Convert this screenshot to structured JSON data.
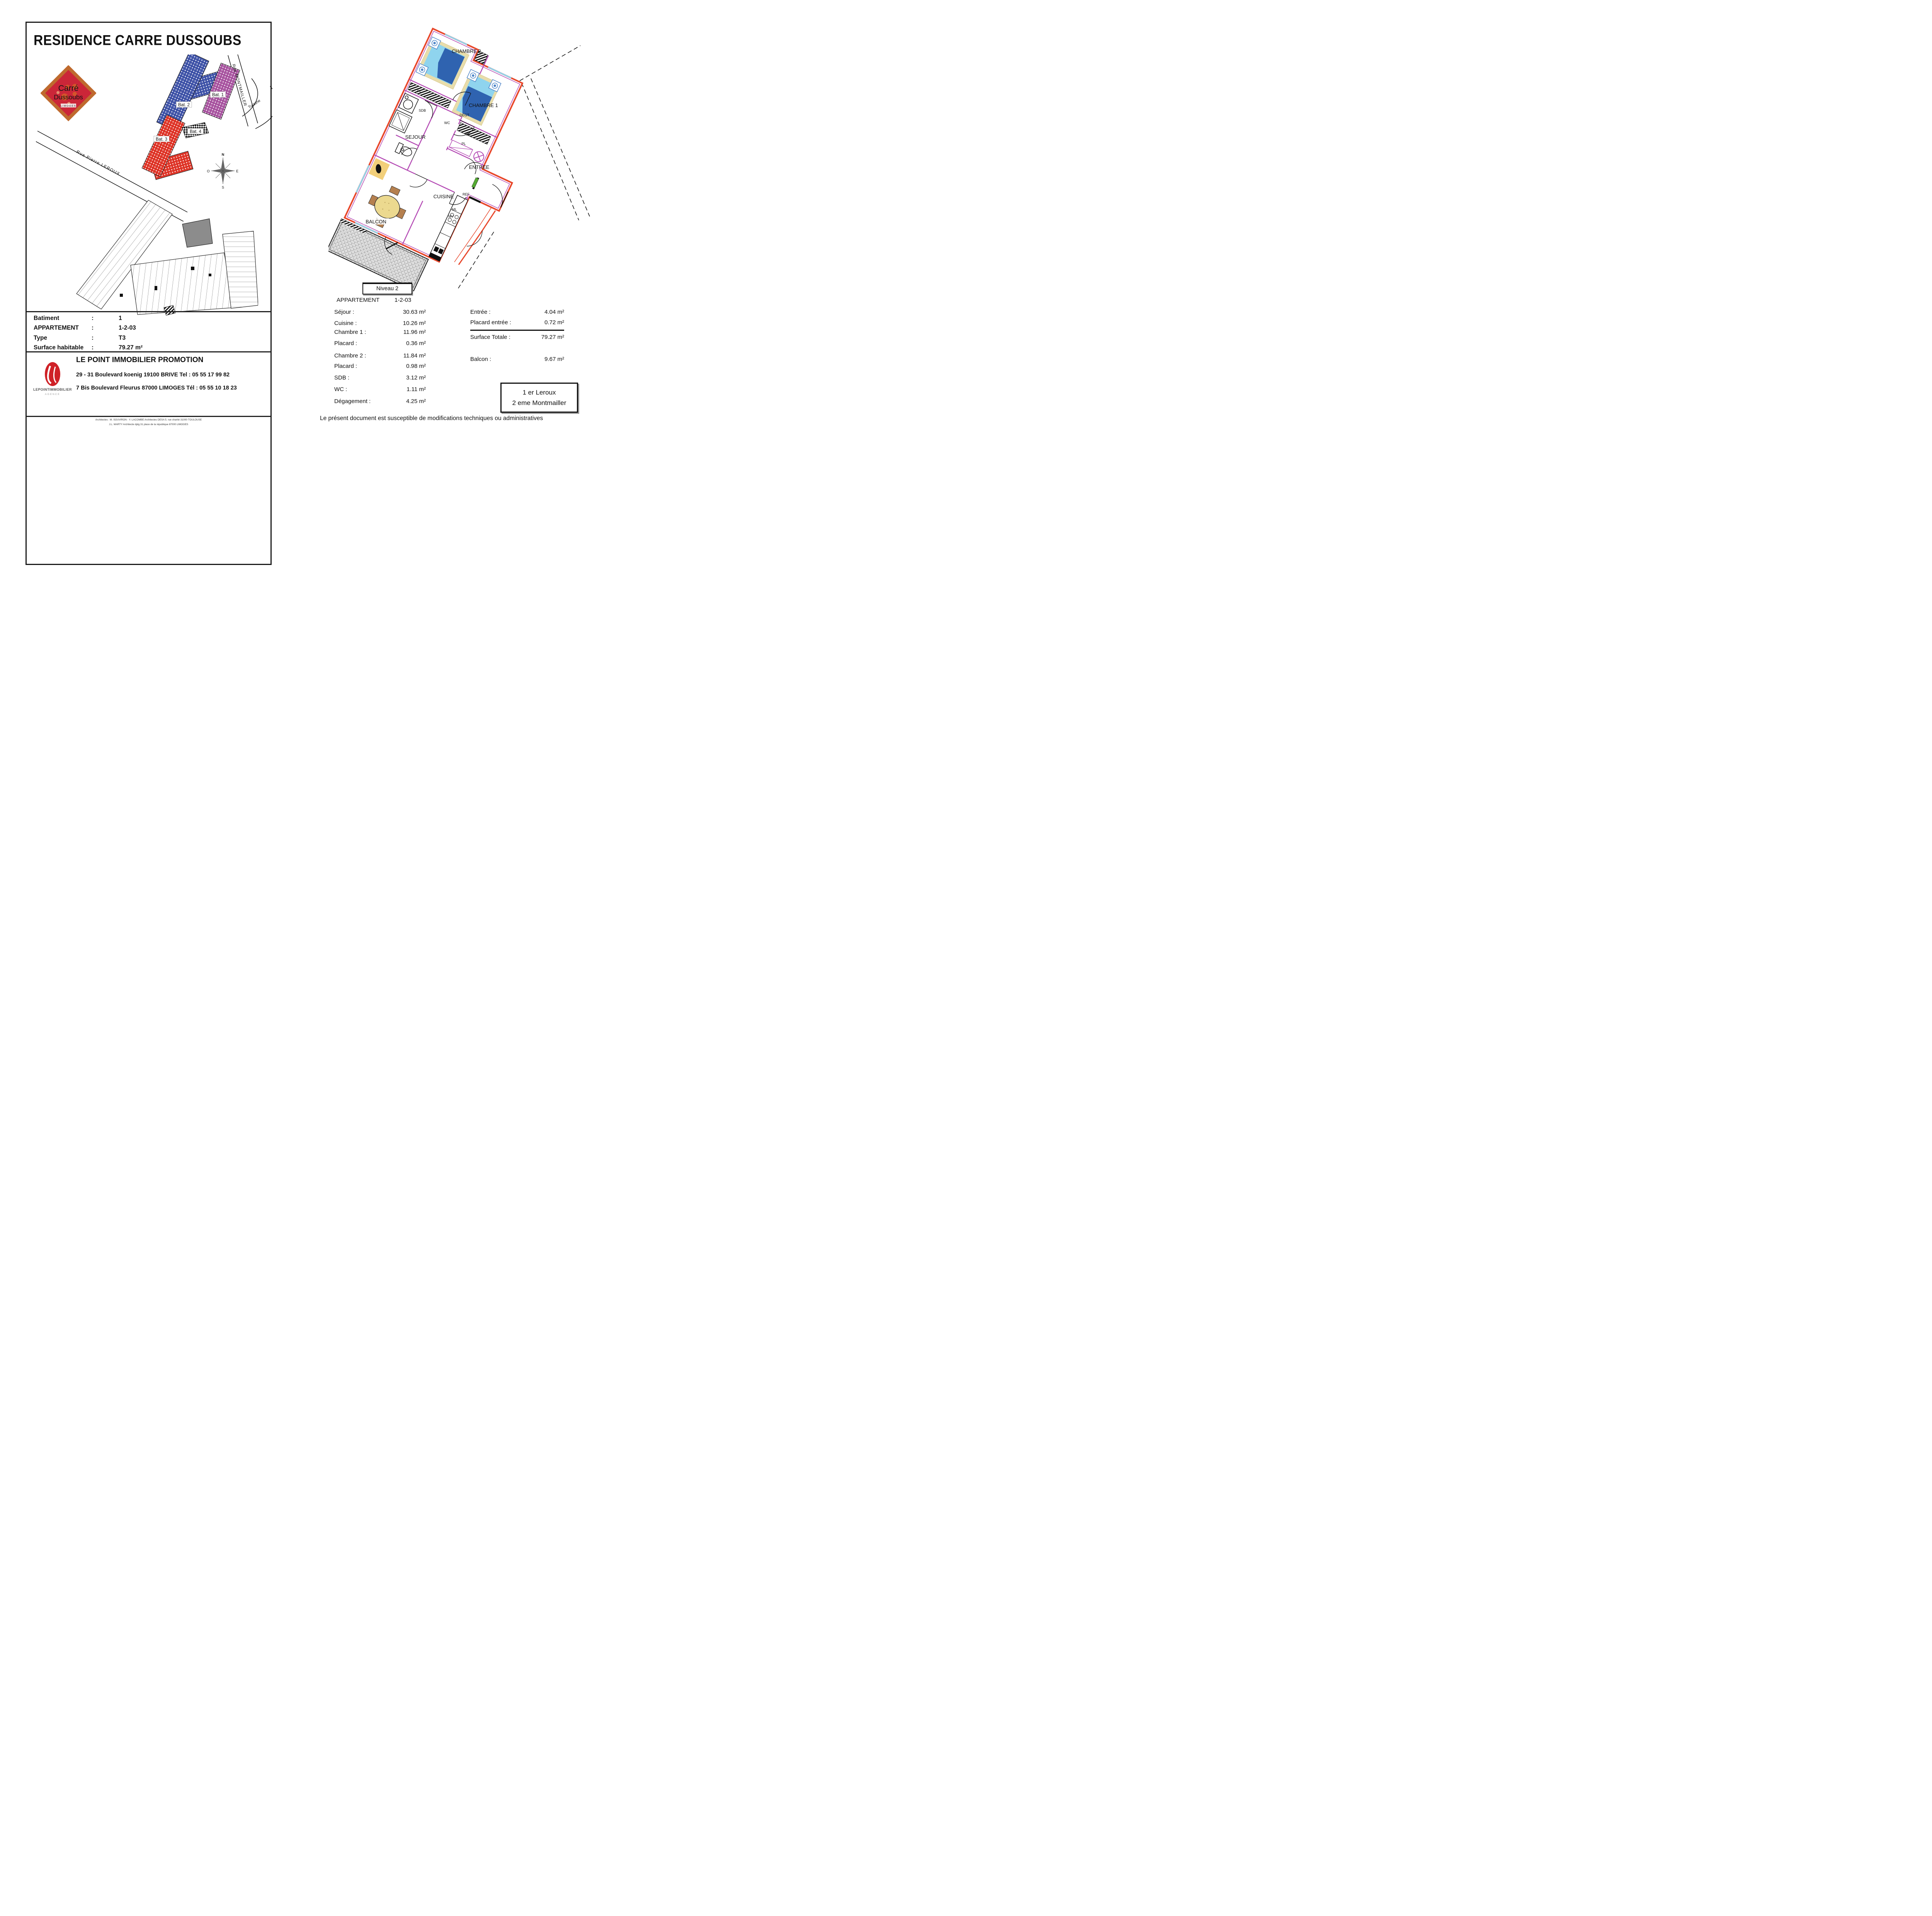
{
  "colors": {
    "exterior_wall": "#e8472b",
    "interior_wall": "#b44ab4",
    "building1": "#a855a0",
    "building2": "#4054a8",
    "building3": "#de3528",
    "bed_dark": "#2f63b0",
    "bed_light": "#8fd4ee",
    "bed_frame": "#e8ddab",
    "table": "#ecd98f",
    "chair": "#b5804f",
    "balcony_hatch": "#9a9a9a",
    "logo_border": "#bf6a2e",
    "logo_field": "#cb2638",
    "logo_text": "#f5ecd9",
    "logo_city": "#3a9ec8",
    "agency_red": "#cf2127",
    "highlight_grey": "#8c8c8c",
    "accent_green": "#55aa33",
    "accent_yellow": "#f2cf7a"
  },
  "left_page": {
    "title": "RESIDENCE CARRE DUSSOUBS",
    "logo": {
      "line1": "Carré",
      "line2": "Dussoubs",
      "city": "LIMOGES"
    },
    "site_plan": {
      "buildings": [
        {
          "label": "Bat. 1"
        },
        {
          "label": "Bat. 2"
        },
        {
          "label": "Bat. 3"
        },
        {
          "label": "Bat. 4"
        }
      ],
      "street_montmailler": "Rue   MONTMAILLER",
      "street_tulasne": "Tulasne",
      "street_leroux": "Rue   Pierre   LEROUX",
      "compass": {
        "n": "N",
        "o": "O",
        "e": "E",
        "s": "S"
      }
    },
    "info_rows": [
      {
        "label": "Batiment",
        "colon": ":",
        "value": "1"
      },
      {
        "label": "APPARTEMENT",
        "colon": ":",
        "value": "1-2-03"
      },
      {
        "label": "Type",
        "colon": ":",
        "value": "T3"
      },
      {
        "label": "Surface habitable",
        "colon": ":",
        "value": "79.27 m²"
      }
    ],
    "promoter": {
      "brand": "LEPOINTIMMOBILIER",
      "brand_sub": "AGENCE",
      "name": "LE POINT IMMOBILIER PROMOTION",
      "address1": "29 - 31 Boulevard koenig 19100  BRIVE Tel : 05 55 17 99 82",
      "address2": "7 Bis Boulevard Fleurus 87000 LIMOGES Tél : 05 55 10 18 23"
    },
    "architects_line1": "Architectes : M. SOUVIRON - Y. LACOMBE Architectes DESA  5. rue charité 31000 TOULOUSE",
    "architects_line2": "J.L. MARTY Architecte dplg  31 place de la république 87000 LIMOGES"
  },
  "right_page": {
    "plan_labels": {
      "chambre2": "CHAMBRE 2",
      "chambre1": "CHAMBRE 1",
      "sejour": "SEJOUR",
      "cuisine": "CUISINE",
      "balcon": "BALCON",
      "entree": "ENTREE",
      "sdb": "SDB",
      "wc": "WC",
      "degt": "DEGT",
      "pl1": "PL",
      "pl2": "PL",
      "pl3": "PL",
      "ref": "REF",
      "ml": "ML",
      "mv": "MV"
    },
    "level_box": "Niveau 2",
    "apartment": {
      "label": "APPARTEMENT",
      "value": "1-2-03"
    },
    "areas_left": [
      {
        "label": "Séjour :",
        "value": "30.63 m²"
      },
      {
        "label": "Cuisine :",
        "value": "10.26 m²"
      },
      {
        "label": "Chambre 1 :",
        "value": "11.96 m²"
      },
      {
        "label": "Placard :",
        "value": "0.36 m²"
      },
      {
        "label": "Chambre 2 :",
        "value": "11.84 m²"
      },
      {
        "label": "Placard :",
        "value": "0.98 m²"
      },
      {
        "label": "SDB :",
        "value": "3.12 m²"
      },
      {
        "label": "WC :",
        "value": "1.11 m²"
      },
      {
        "label": "Dégagement :",
        "value": "4.25 m²"
      }
    ],
    "areas_right": [
      {
        "label": "Entrée :",
        "value": "4.04 m²"
      },
      {
        "label": "Placard entrée :",
        "value": "0.72 m²"
      },
      {
        "label": "Surface Totale :",
        "value": "79.27 m²"
      },
      {
        "label": "Balcon :",
        "value": "9.67 m²"
      }
    ],
    "floors_box": {
      "line1": "1 er Leroux",
      "line2": "2 eme Montmailler"
    },
    "disclaimer": "Le présent document est susceptible de modifications techniques ou administratives"
  }
}
